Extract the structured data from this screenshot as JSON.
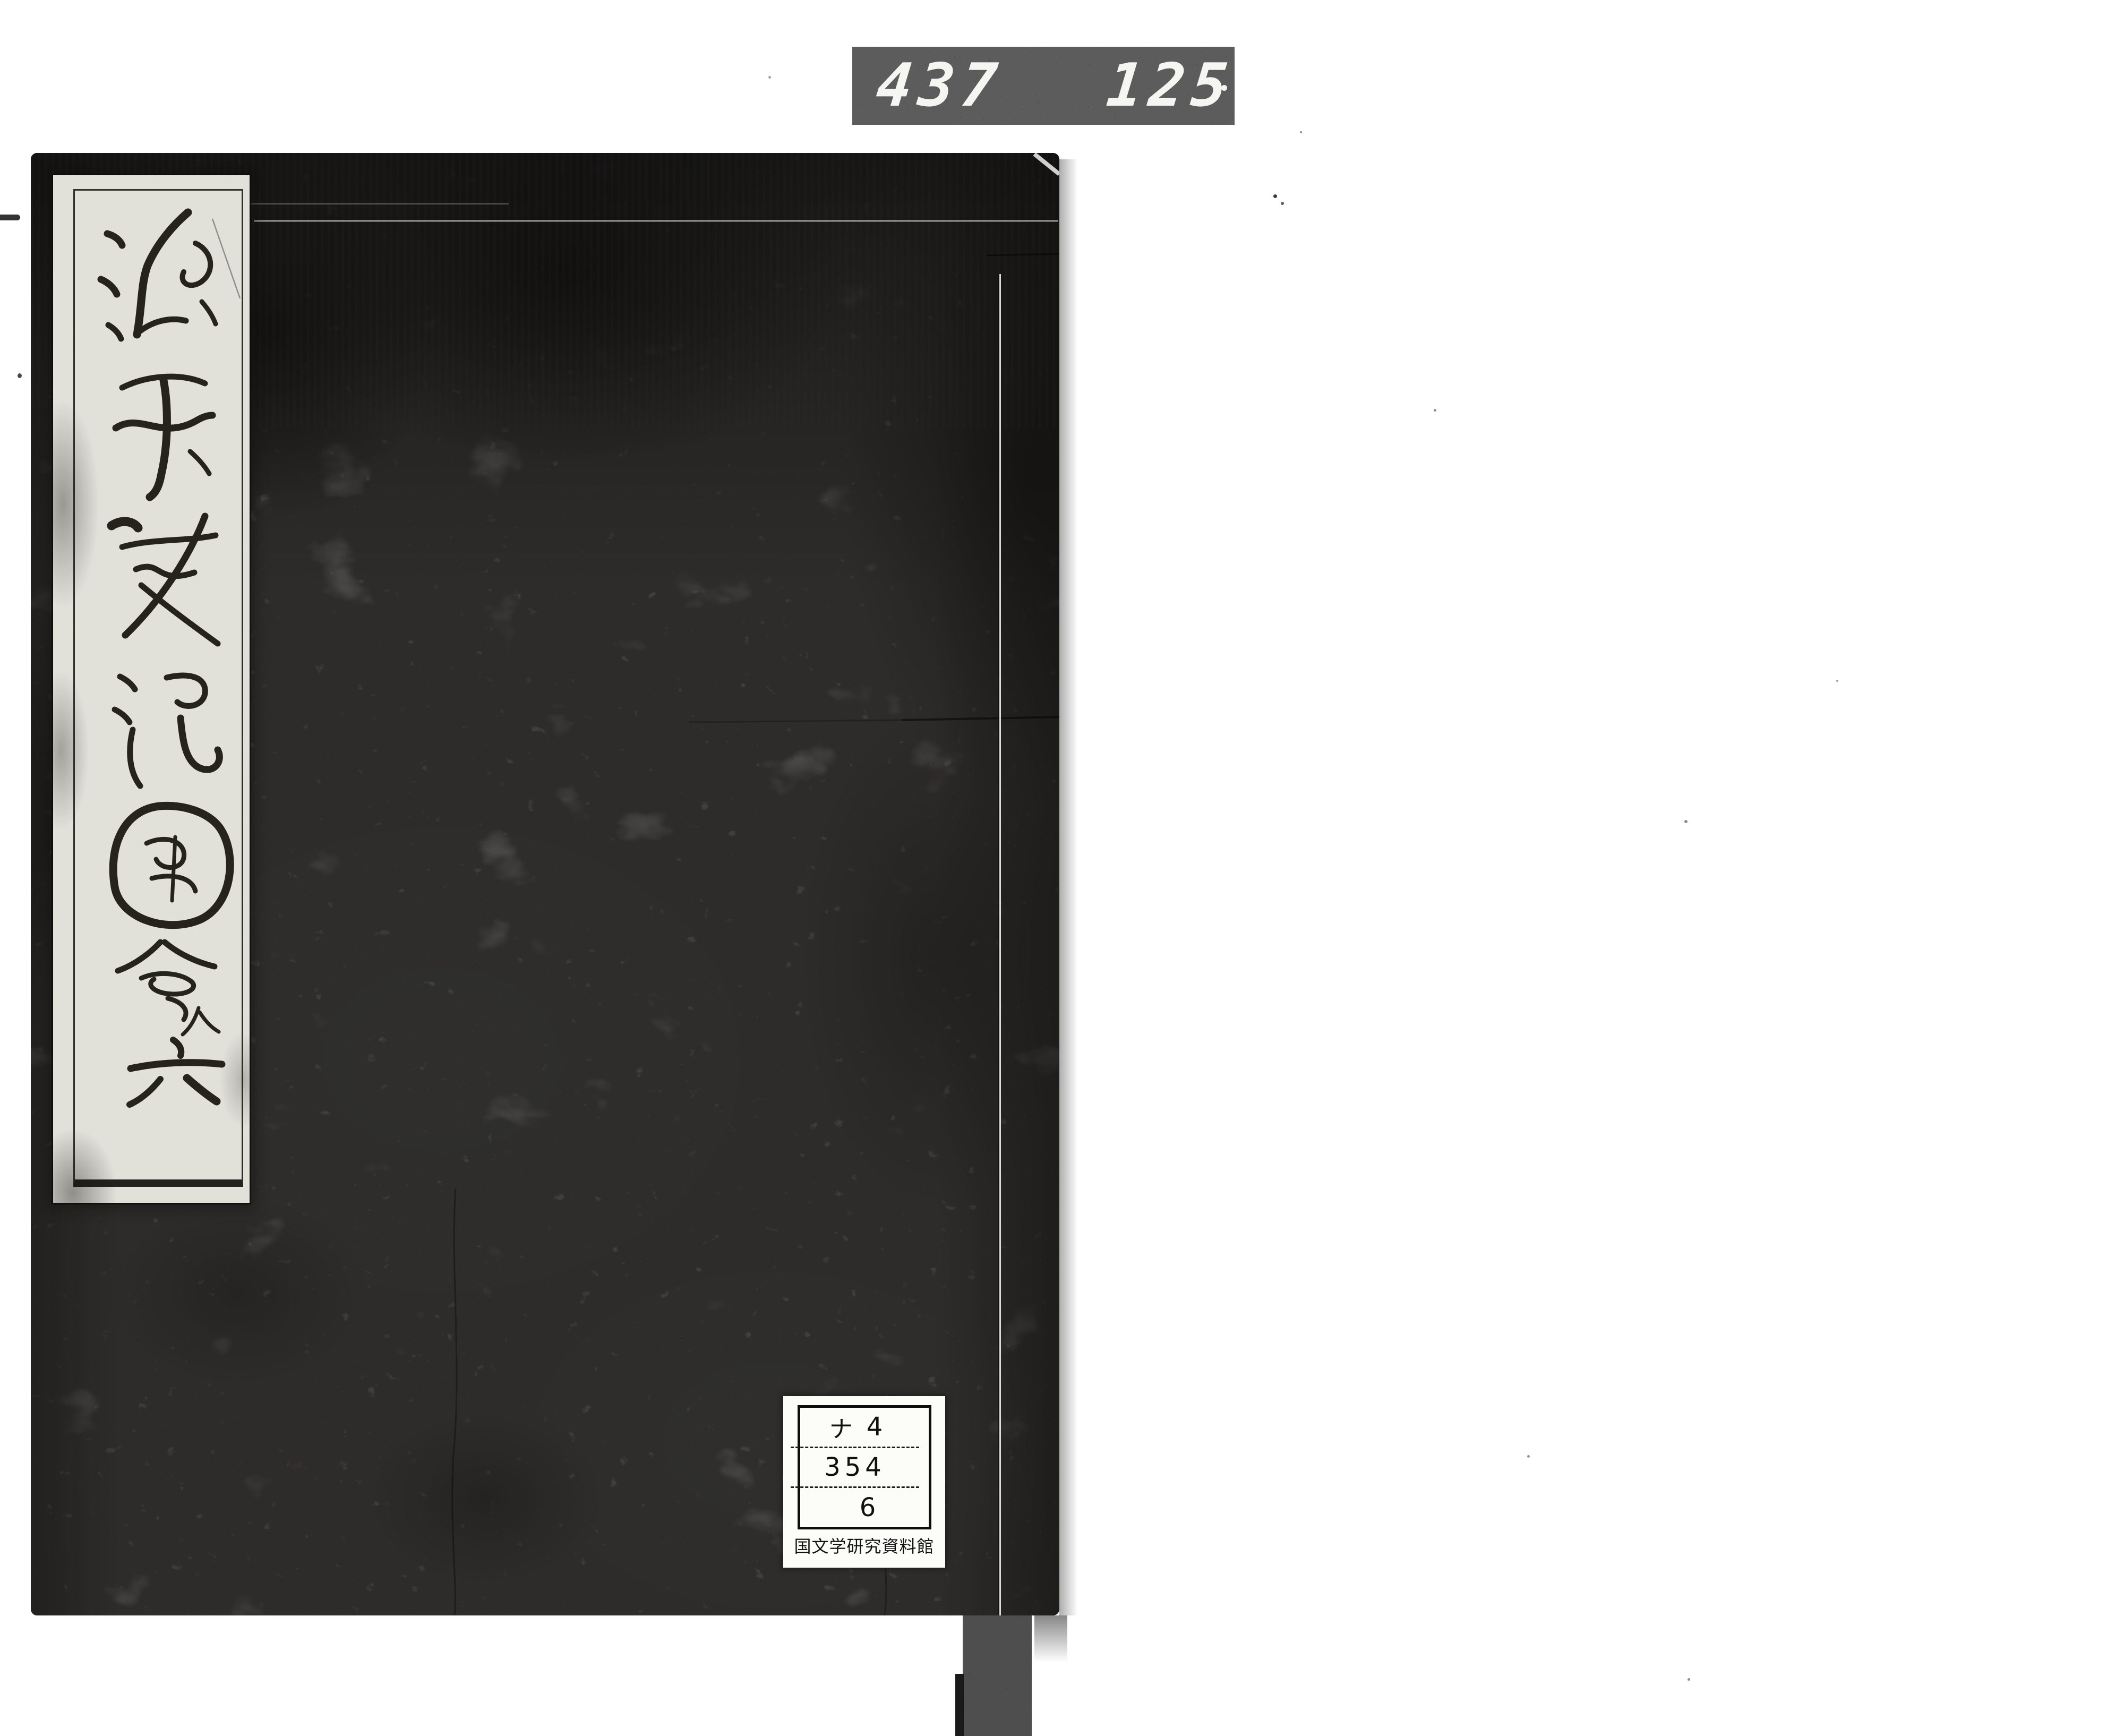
{
  "film_counter": {
    "left_number": "437",
    "right_number": "125"
  },
  "cover": {
    "title_label": {
      "title": "源平盛衰記図会",
      "volume_note": "入",
      "volume": "六"
    },
    "library_label": {
      "call_number_row1_kana": "ナ",
      "call_number_row1_number": "4",
      "call_number_row2": "354",
      "call_number_row3": "6",
      "institution": "国文学研究資料館"
    }
  },
  "colors": {
    "page-bg": "#ffffff",
    "cover-base": "#eceae5",
    "counter-bg": "#0b0b0b",
    "counter-digits": "#f5f5f2",
    "slip-bg": "#f7f6f0",
    "ink": "#17130d",
    "sticker-bg": "#fcfcf9"
  }
}
